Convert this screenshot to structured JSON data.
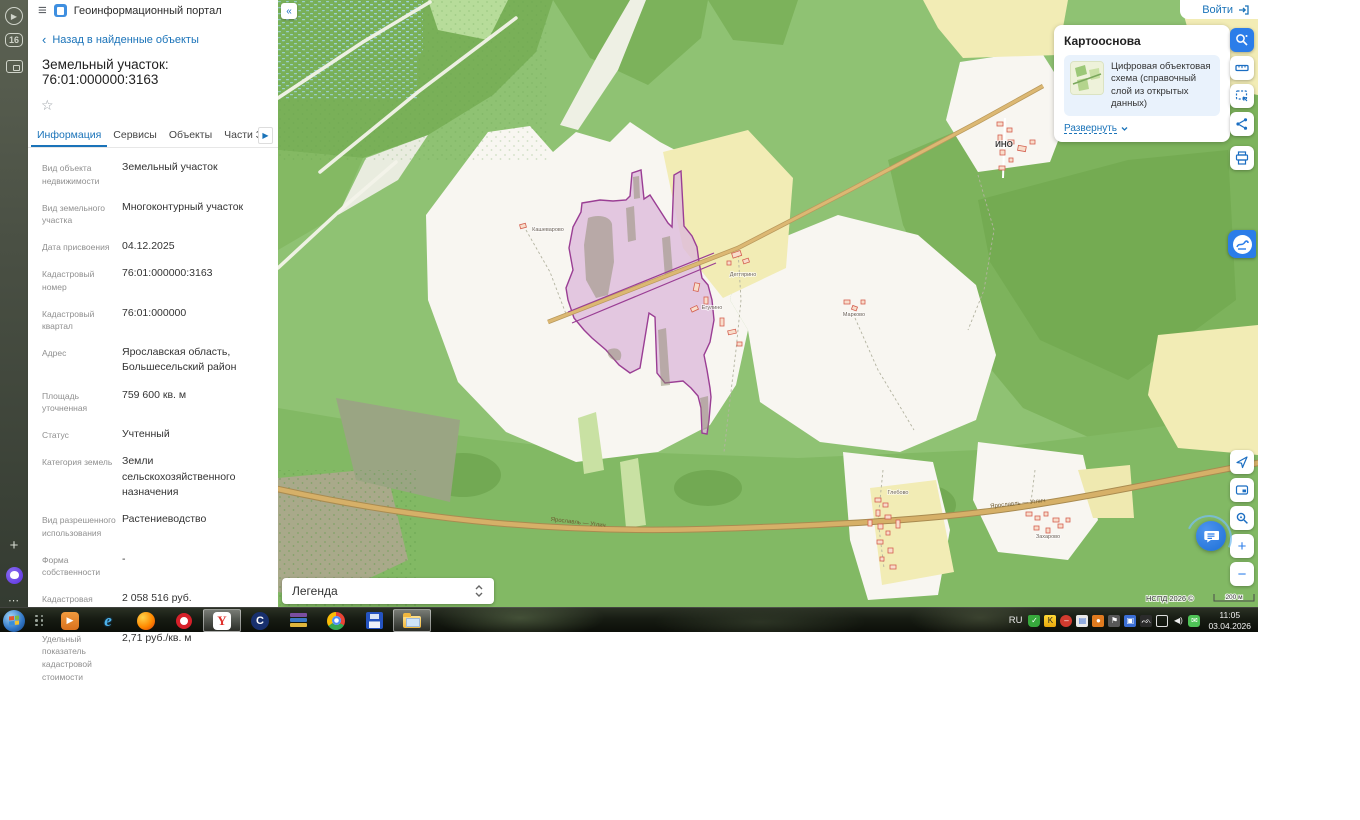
{
  "colors": {
    "accent_blue": "#1a73b9",
    "active_tool": "#2b7de9",
    "parcel_stroke": "#9a3e94",
    "parcel_fill": "#ddbcdc"
  },
  "browser_sidebar": {
    "icons": [
      "video-play-icon",
      "tab-count-badge",
      "screen-capture-icon",
      "add-icon",
      "alice-assistant-icon",
      "more-icon"
    ],
    "tab_count": "16",
    "more_glyph": "⋯"
  },
  "header": {
    "app_title": "Геоинформационный портал"
  },
  "panel": {
    "back_link": "Назад в найденные объекты",
    "title": "Земельный участок: 76:01:000000:3163",
    "tabs": [
      {
        "label": "Информация"
      },
      {
        "label": "Сервисы"
      },
      {
        "label": "Объекты"
      },
      {
        "label": "Части ЗУ"
      },
      {
        "label": "Состав"
      }
    ],
    "info_rows": [
      {
        "label": "Вид объекта недвижимости",
        "value": "Земельный участок"
      },
      {
        "label": "Вид земельного участка",
        "value": "Многоконтурный участок"
      },
      {
        "label": "Дата присвоения",
        "value": "04.12.2025"
      },
      {
        "label": "Кадастровый номер",
        "value": "76:01:000000:3163"
      },
      {
        "label": "Кадастровый квартал",
        "value": "76:01:000000"
      },
      {
        "label": "Адрес",
        "value": "Ярославская область, Большесельский район"
      },
      {
        "label": "Площадь уточненная",
        "value": "759 600 кв. м"
      },
      {
        "label": "Статус",
        "value": "Учтенный"
      },
      {
        "label": "Категория земель",
        "value": "Земли сельскохозяйственного назначения"
      },
      {
        "label": "Вид разрешенного использования",
        "value": "Растениеводство"
      },
      {
        "label": "Форма собственности",
        "value": "-"
      },
      {
        "label": "Кадастровая стоимость",
        "value": "2 058 516 руб."
      },
      {
        "label": "Удельный показатель кадастровой стоимости",
        "value": "2,71 руб./кв. м"
      }
    ]
  },
  "map": {
    "login_label": "Войти",
    "basemap_card": {
      "title": "Картооснова",
      "layer_description": "Цифровая объектовая схема (справочный слой из открытых данных)",
      "expand_label": "Развернуть"
    },
    "legend_label": "Легенда",
    "attribution": "НСПД 2026 ©",
    "scale_label": "200 м",
    "labels": {
      "ino": "ИНО",
      "kashevarovo": "Кашеварово",
      "degtyarino": "Дегтярино",
      "egulino": "Егулино",
      "markovo": "Марково",
      "glebovo": "Глебово",
      "zakharovo": "Захарово",
      "road1": "Ярославль — Углич",
      "road2": "Ярославль — Углич"
    },
    "tools_top": [
      "object-search-icon",
      "ruler-icon",
      "select-area-icon",
      "share-icon",
      "print-icon"
    ],
    "tools_bottom": [
      "locate-icon",
      "overview-map-icon",
      "search-location-icon",
      "zoom-in",
      "zoom-out"
    ],
    "zoom_in_glyph": "+",
    "zoom_out_glyph": "−"
  },
  "taskbar": {
    "apps": [
      "start-button",
      "quick-launch",
      "media-player",
      "internet-explorer",
      "firefox",
      "opera",
      "yandex-browser",
      "sputnik-browser",
      "winrar",
      "chrome",
      "floppy-app",
      "file-explorer"
    ],
    "tray": {
      "lang": "RU",
      "icons": [
        "antivirus-shield",
        "kaspersky",
        "blocked",
        "updates",
        "archive",
        "flag",
        "sync",
        "eagle",
        "display",
        "volume",
        "messenger"
      ],
      "time": "11:05",
      "date": "03.04.2026"
    }
  }
}
